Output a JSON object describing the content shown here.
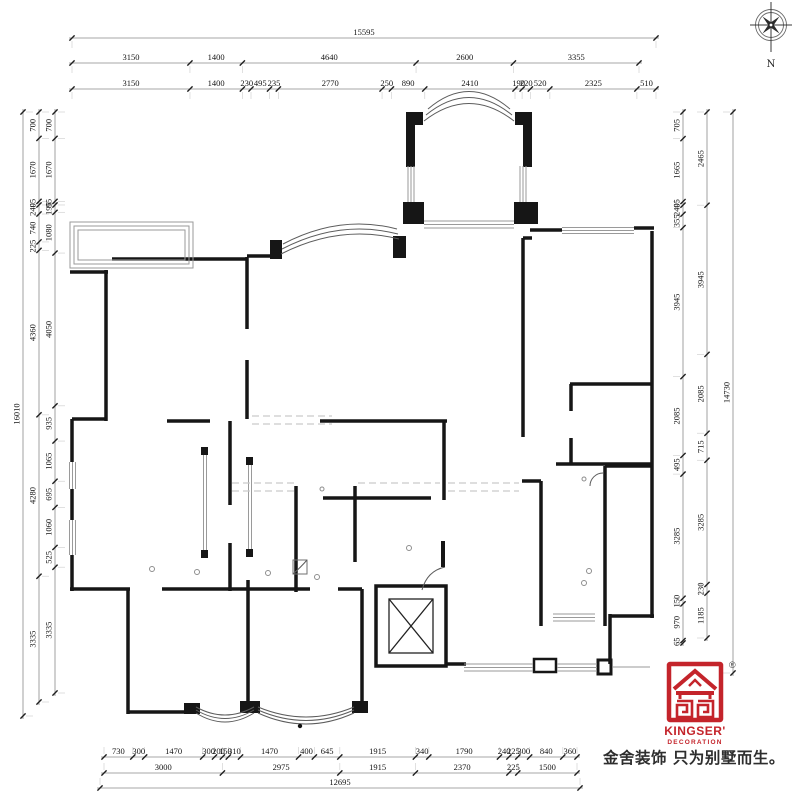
{
  "compass": {
    "north_label": "N"
  },
  "dimensions": {
    "top": {
      "total": [
        "15595"
      ],
      "mid": [
        "3150",
        "1400",
        "4640",
        "2600",
        "3355"
      ],
      "inner": [
        "3150",
        "1400",
        "230",
        "495",
        "235",
        "2770",
        "250",
        "890",
        "2410",
        "190",
        "220",
        "520",
        "2325",
        "510"
      ]
    },
    "left": {
      "total": [
        "16010"
      ],
      "mid": [
        "700",
        "1670",
        "95",
        "240",
        "740",
        "225",
        "4360",
        "4280",
        "3335"
      ],
      "inner": [
        "700",
        "1670",
        "95",
        "195",
        "1080",
        "4050",
        "935",
        "1065",
        "695",
        "1060",
        "525",
        "3335"
      ]
    },
    "right": {
      "inner": [
        "705",
        "1665",
        "95",
        "240",
        "355",
        "3945",
        "2085",
        "495",
        "3285",
        "150",
        "970",
        "65"
      ],
      "mid": [
        "2465",
        "3945",
        "2085",
        "715",
        "3285",
        "230",
        "1185"
      ],
      "total": [
        "14730"
      ]
    },
    "bottom": {
      "inner": [
        "730",
        "300",
        "1470",
        "300",
        "200",
        "150",
        "310",
        "1470",
        "400",
        "645",
        "1915",
        "340",
        "1790",
        "240",
        "225",
        "300",
        "840",
        "360"
      ],
      "mid": [
        "3000",
        "2975",
        "1915",
        "2370",
        "225",
        "1500"
      ],
      "total": [
        "12695"
      ]
    }
  },
  "logo": {
    "brand": "KINGSER'",
    "sub": "DECORATION",
    "registered": "®",
    "tagline": "金舍装饰 只为别墅而生。"
  },
  "colors": {
    "wall": "#161616",
    "window_line": "#9a9a9a",
    "dimension_text": "#141414",
    "logo_red": "#c4242b",
    "tagline_text": "#2e2e2e"
  }
}
